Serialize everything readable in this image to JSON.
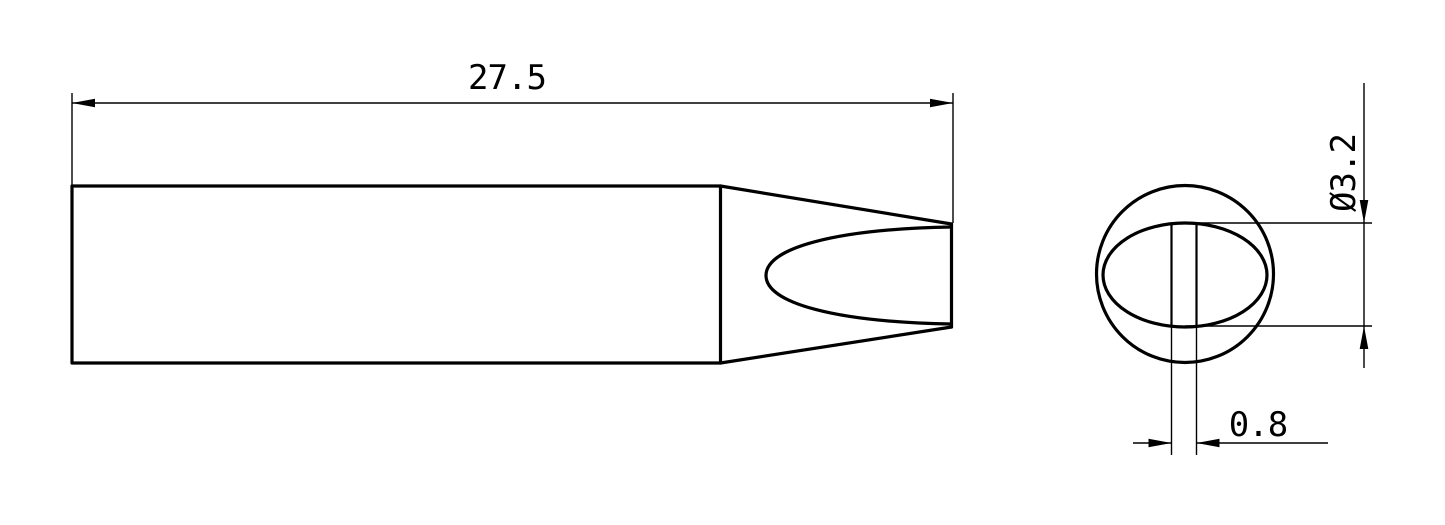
{
  "drawing": {
    "background_color": "#ffffff",
    "line_color": "#000000",
    "dimensions": {
      "length": {
        "label": "27.5"
      },
      "diameter": {
        "label": "Ø3.2"
      },
      "edge_width": {
        "label": "0.8"
      }
    }
  }
}
